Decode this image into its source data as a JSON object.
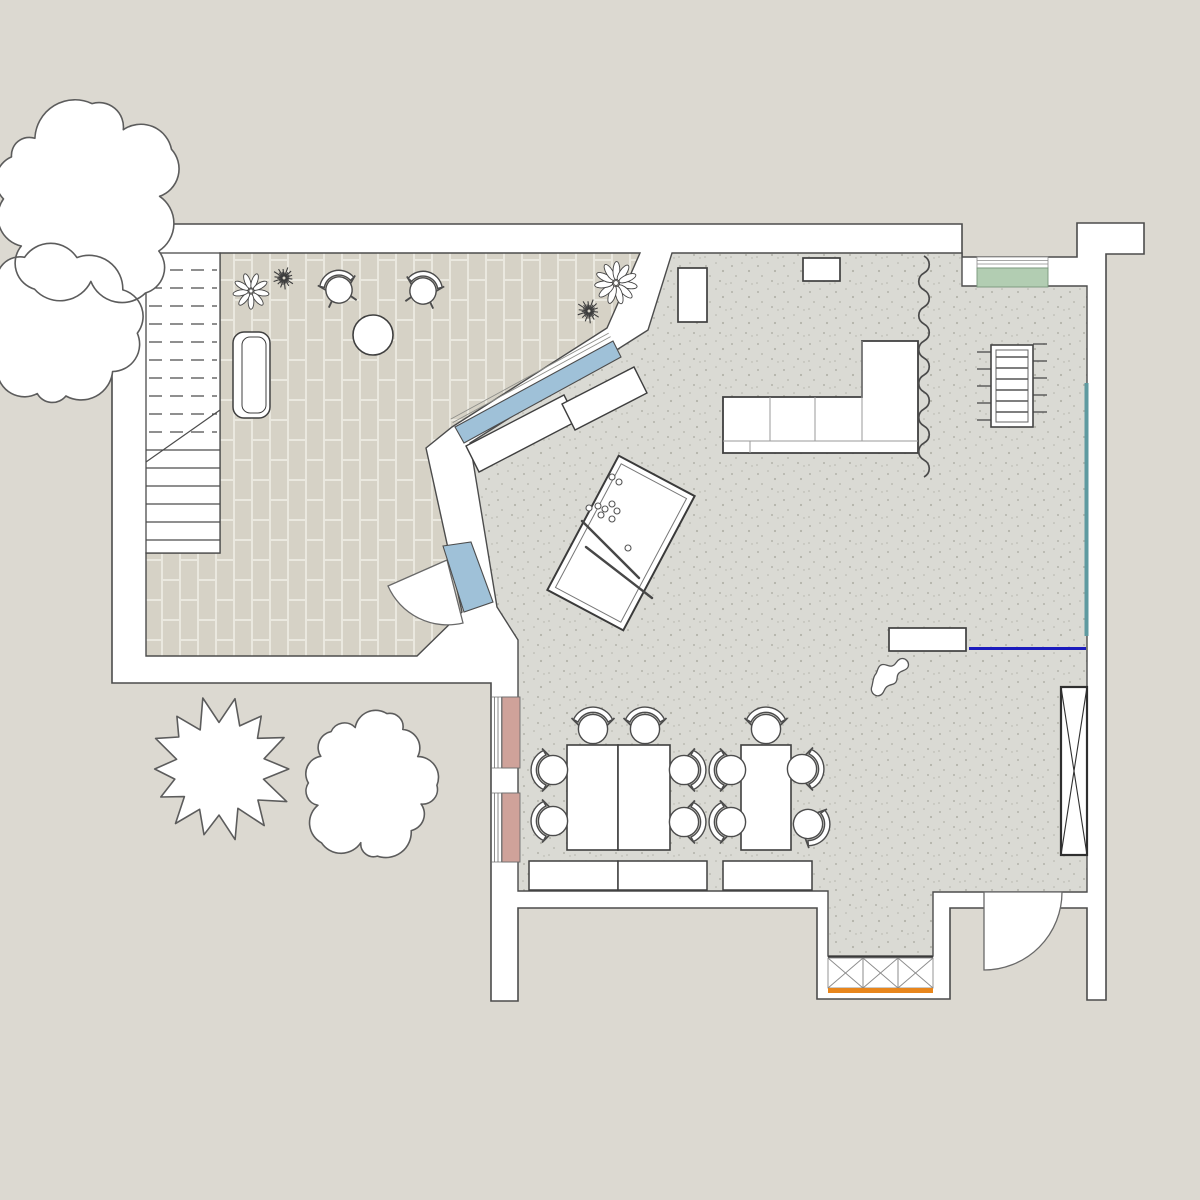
{
  "meta": {
    "title": "Residential ground-floor plan with terrace",
    "kind": "architectural-floor-plan",
    "visible_text": []
  },
  "canvas": {
    "w": 1200,
    "h": 1200
  },
  "colors": {
    "background": "#dcd9d1",
    "wall_fill": "#ffffff",
    "outline": "#4c4c4c",
    "outline_soft": "#8f8f8a",
    "terrace_brick": "#d6d2c6",
    "terrace_joint": "#eae8df",
    "floor_base": "#dadad4",
    "floor_speckle": "#b3b3aa",
    "window_blue": "#9fc1d8",
    "window_pink": "#cfa29a",
    "window_green": "#b2cdb2",
    "accent_teal": "#5f9aa0",
    "accent_blue": "#1b1bbd",
    "accent_orange": "#e8861c",
    "tree_stroke": "#5c5c5c"
  },
  "plan": {
    "building_outline": "M112,224 L962,224 L962,257 L1077,257 L1077,223 L1144,223 L1144,254 L1106,254 L1106,1000 L1087,1000 L1087,908 L950,908 L950,999 L817,999 L817,908 L518,908 L518,1001 L491,1001 L491,683 L112,683 Z",
    "terrace_floor": "M220,253 L640,253 L607,328 L452,427 L426,448 L462,612 L417,656 L146,656 L146,553 L220,553 Z",
    "main_floor": "M672,253 L962,253 L962,286 L1087,286 L1087,892 L933,892 L933,956 L828,956 L828,891 L518,891 L518,640 L497,607 L470,443 L648,330 Z",
    "stairs": {
      "x": 146,
      "y": 253,
      "w": 74,
      "h": 300,
      "dashed_treads": [
        270,
        288,
        306,
        324,
        342,
        360,
        378,
        396,
        414,
        432
      ],
      "solid_treads": [
        450,
        468,
        486,
        504,
        522,
        540
      ],
      "diagonal": [
        220,
        410,
        146,
        462
      ],
      "dash_pattern": "13 8"
    },
    "doors": [
      {
        "name": "terrace-door-swing",
        "pie": "M447,560 L388,586 A65,65 0 0 0 463,623 Z"
      },
      {
        "name": "entrance-door-swing",
        "pie": "M984,892 L984,970 A78,78 0 0 0 1062,892 Z"
      }
    ],
    "windows": {
      "angled_blue": "M613,341 L621,357 L464,443 L455,427 Z",
      "angled_sill_lines": [
        [
          610.6,
          336.6,
          452.6,
          422.6
        ],
        [
          608.7,
          333.1,
          450.7,
          419.1
        ]
      ],
      "door_blue": "M443,546 L471,542 L493,602 L464,612 Z",
      "pink": [
        {
          "x": 502,
          "y": 697,
          "w": 18,
          "h": 71
        },
        {
          "x": 502,
          "y": 793,
          "w": 18,
          "h": 69
        }
      ],
      "pink_glazing_x": [
        494.5,
        498,
        501.5
      ],
      "pink_jamb_y": [
        697,
        768,
        793,
        862
      ],
      "green": {
        "x": 977,
        "y": 268,
        "w": 71,
        "h": 19
      },
      "green_sill": {
        "x": 977,
        "y": 257,
        "w": 71,
        "h": 11,
        "lines": [
          260.5,
          264
        ]
      },
      "teal_strip": {
        "x": 1084.5,
        "y": 383,
        "w": 4,
        "h": 253
      }
    },
    "niche_grille": {
      "x": 828,
      "y": 957,
      "w": 105,
      "h": 33,
      "boxes": 3,
      "orange_y": 988,
      "orange_h": 5
    },
    "radiator": {
      "x": 991,
      "y": 345,
      "w": 42,
      "h": 82,
      "inset": 5,
      "rungs": [
        357,
        368,
        379,
        390,
        401,
        412
      ],
      "fins_left": [
        352,
        369,
        386,
        403,
        420
      ],
      "fins_right": [
        344,
        361,
        378,
        395,
        412
      ],
      "fin_len": 14
    },
    "furniture": {
      "sofa_outline": "M723,397 L862,397 L862,341 L918,341 L918,453 L723,453 Z",
      "sofa_lines": [
        [
          770,
          397,
          770,
          441
        ],
        [
          815,
          397,
          815,
          441
        ],
        [
          862,
          341,
          862,
          441
        ],
        [
          723,
          441,
          918,
          441
        ],
        [
          750,
          441,
          750,
          453
        ]
      ],
      "tall_cabinet": {
        "x": 678,
        "y": 268,
        "w": 29,
        "h": 54
      },
      "wall_cabinet": {
        "x": 803,
        "y": 258,
        "w": 37,
        "h": 23
      },
      "wall_shelf": {
        "x": 889,
        "y": 628,
        "w": 77,
        "h": 23
      },
      "accent_rail": {
        "x": 969,
        "y": 647,
        "w": 117,
        "h": 3
      },
      "wardrobe_x": {
        "x": 1061,
        "y": 687,
        "w": 26,
        "h": 168
      },
      "sideboard_segments": [
        "M466,446 L564,395 L577,421 L479,472 Z",
        "M562,404 L634,367 L647,393 L575,430 Z"
      ],
      "terrace_bench": {
        "x": 233,
        "y": 332,
        "w": 37,
        "h": 86,
        "rx": 11,
        "inner": {
          "x": 242,
          "y": 337,
          "w": 24,
          "h": 76,
          "rx": 8
        }
      },
      "round_table": {
        "cx": 373,
        "cy": 335,
        "r": 20
      },
      "dining_tables": [
        {
          "x": 567,
          "y": 745,
          "w": 51,
          "h": 105
        },
        {
          "x": 618,
          "y": 745,
          "w": 52,
          "h": 105
        },
        {
          "x": 741,
          "y": 745,
          "w": 50,
          "h": 105
        }
      ],
      "storage_benches": [
        {
          "x": 529,
          "y": 861,
          "w": 89,
          "h": 29
        },
        {
          "x": 618,
          "y": 861,
          "w": 89,
          "h": 29
        },
        {
          "x": 723,
          "y": 861,
          "w": 89,
          "h": 29
        }
      ],
      "billiard": {
        "cx": 621,
        "cy": 543,
        "w": 86,
        "h": 152,
        "rot": 28,
        "inset": 6,
        "balls": [
          [
            612,
            477
          ],
          [
            619,
            482
          ],
          [
            589,
            508
          ],
          [
            598,
            506
          ],
          [
            605,
            509
          ],
          [
            612,
            504
          ],
          [
            617,
            511
          ],
          [
            601,
            515
          ],
          [
            612,
            519
          ],
          [
            628,
            548
          ]
        ],
        "cues": [
          [
            582,
            521,
            639,
            578
          ],
          [
            586,
            547,
            652,
            598
          ]
        ]
      },
      "pet_blob": "M872,686 c-3,7 5,13 10,8 c3,-3 2,-6 6,-8 c3,-2 6,-1 8,-4 c2,-3 0,-6 3,-9 c3,-3 7,-2 9,-6 c2,-5 -3,-10 -8,-8 c-4,2 -4,6 -8,7 c-4,1 -7,-3 -11,-1 c-4,2 -3,7 -6,10 c-2,3 -2,7 -3,11 Z"
    },
    "chairs": [
      {
        "x": 339,
        "y": 290,
        "rot": -15,
        "r": 13.5,
        "feet": true,
        "zone": "terrace"
      },
      {
        "x": 423,
        "y": 291,
        "rot": 15,
        "r": 13.5,
        "feet": true,
        "zone": "terrace"
      },
      {
        "x": 593,
        "y": 729,
        "rot": 0,
        "zone": "dining"
      },
      {
        "x": 645,
        "y": 729,
        "rot": 0,
        "zone": "dining"
      },
      {
        "x": 553,
        "y": 770,
        "rot": -90,
        "zone": "dining"
      },
      {
        "x": 553,
        "y": 821,
        "rot": -90,
        "zone": "dining"
      },
      {
        "x": 684,
        "y": 770,
        "rot": 90,
        "zone": "dining"
      },
      {
        "x": 684,
        "y": 822,
        "rot": 90,
        "zone": "dining"
      },
      {
        "x": 766,
        "y": 729,
        "rot": 0,
        "zone": "dining"
      },
      {
        "x": 731,
        "y": 770,
        "rot": -90,
        "zone": "dining"
      },
      {
        "x": 731,
        "y": 822,
        "rot": -90,
        "zone": "dining"
      },
      {
        "x": 802,
        "y": 769,
        "rot": 90,
        "zone": "dining"
      },
      {
        "x": 808,
        "y": 824,
        "rot": 115,
        "zone": "dining"
      }
    ],
    "plants": [
      {
        "type": "daisy",
        "x": 251,
        "y": 291,
        "r": 17,
        "petals": 9
      },
      {
        "type": "spiky",
        "x": 284,
        "y": 278,
        "r": 12,
        "blades": 14
      },
      {
        "type": "daisy",
        "x": 616,
        "y": 283,
        "r": 20,
        "petals": 11
      },
      {
        "type": "spiky",
        "x": 589,
        "y": 311,
        "r": 13,
        "blades": 14
      }
    ],
    "squiggle": {
      "x": 924,
      "y": 256,
      "segments": 13,
      "step": 17,
      "amp": 7
    },
    "trees": [
      {
        "type": "cloud2",
        "name": "tree-large",
        "blobs": [
          {
            "cx": 85,
            "cy": 205,
            "r": 93,
            "n": 12,
            "seed": 7
          },
          {
            "cx": 52,
            "cy": 330,
            "r": 76,
            "n": 10,
            "seed": 13
          }
        ]
      },
      {
        "type": "jagged",
        "name": "tree-maple",
        "cx": 219,
        "cy": 769,
        "r": 72,
        "n": 14,
        "seed": 5
      },
      {
        "type": "cloud",
        "name": "tree-round",
        "cx": 368,
        "cy": 784,
        "r": 67,
        "n": 14,
        "seed": 9
      }
    ]
  }
}
